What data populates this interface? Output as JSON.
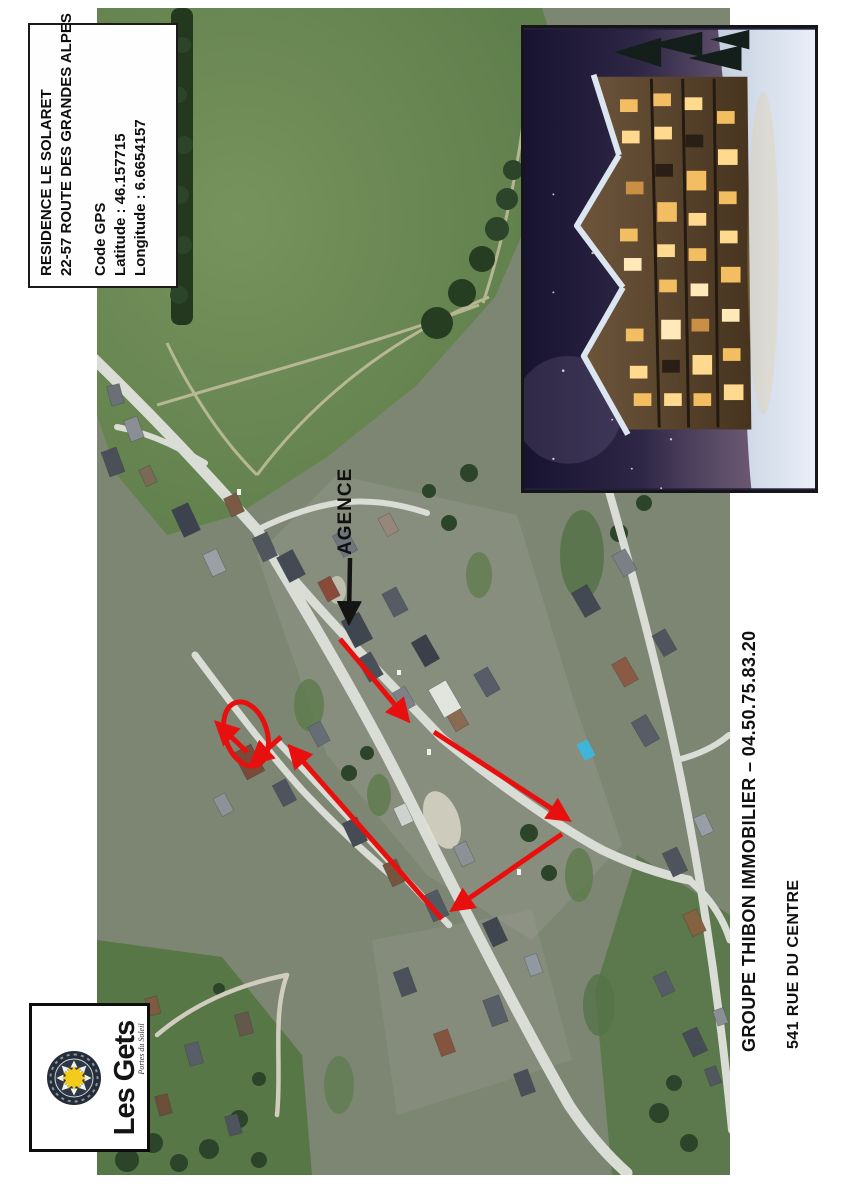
{
  "info_box": {
    "line1": "RESIDENCE LE SOLARET",
    "line2": "22-57 ROUTE DES GRANDES ALPES",
    "gps_title": "Code GPS",
    "latitude": "Latitude : 46.157715",
    "longitude": "Longitude : 6.6654157"
  },
  "map": {
    "agence_label": "AGENCE"
  },
  "logo": {
    "name": "Les Gets",
    "tagline": "Portes du Soleil"
  },
  "footer": {
    "agency_line": "GROUPE THIBON IMMOBILIER – 04.50.75.83.20",
    "address_line": "541 RUE DU CENTRE"
  },
  "colors": {
    "annotation_red": "#e8100f",
    "annotation_black": "#141414",
    "field_green": "#5e7e4b",
    "road_grey": "#dadcd6"
  }
}
